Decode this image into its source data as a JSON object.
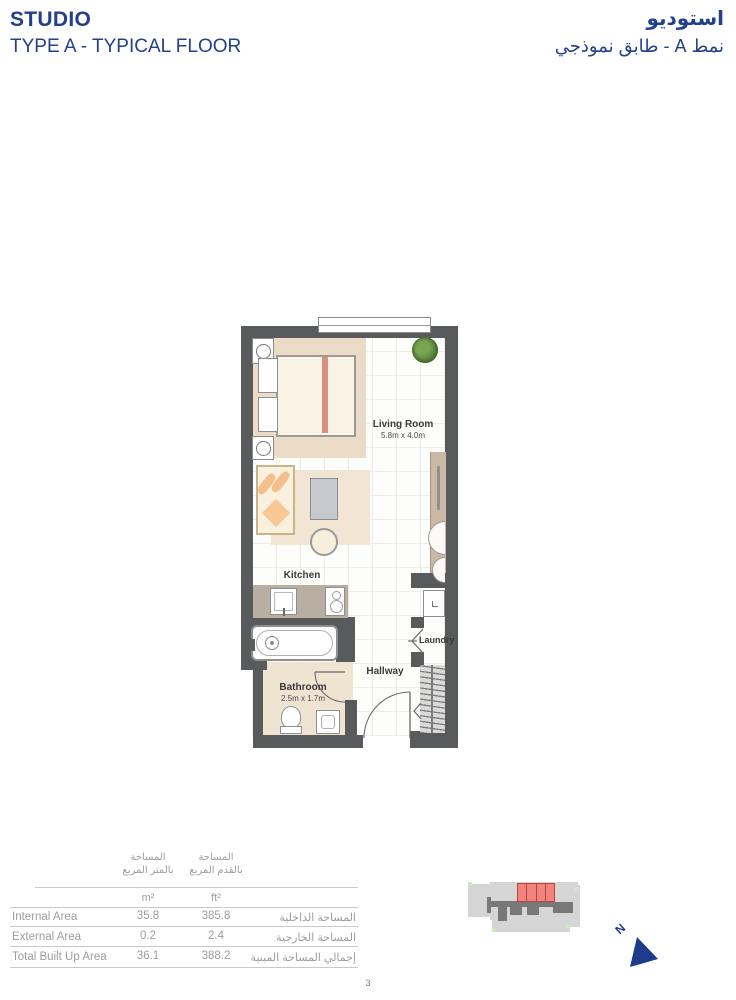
{
  "header": {
    "title_en": "STUDIO",
    "subtitle_en": "TYPE A - TYPICAL FLOOR",
    "title_ar": "استوديو",
    "subtitle_ar": "نمط A - طابق نموذجي",
    "accent_color": "#24408D"
  },
  "floor_plan": {
    "rooms": {
      "living_room": {
        "label": "Living Room",
        "dims": "5.8m x 4.0m"
      },
      "kitchen": {
        "label": "Kitchen"
      },
      "bathroom": {
        "label": "Bathroom",
        "dims": "2.5m x 1.7m"
      },
      "hallway": {
        "label": "Hallway"
      },
      "laundry": {
        "label": "Laundry"
      }
    },
    "colors": {
      "wall": "#595A5C",
      "bedroom_carpet": "#EBDCC8",
      "living_rug": "#F3E5D3",
      "kitchen_counter": "#B9AEA2",
      "wardrobe": "#CBB9A5",
      "bed_runner": "#D98E80"
    }
  },
  "area_table": {
    "col_headers_ar": [
      {
        "line1": "المساحة",
        "line2": "بالمتر المربع"
      },
      {
        "line1": "المساحة",
        "line2": "بالقدم المربع"
      }
    ],
    "unit_headers": [
      "m²",
      "ft²"
    ],
    "rows": [
      {
        "label_en": "Internal Area",
        "m2": "35.8",
        "ft2": "385.8",
        "label_ar": "المساحة الداخلية"
      },
      {
        "label_en": "External Area",
        "m2": "0.2",
        "ft2": "2.4",
        "label_ar": "المساحة الخارجية"
      },
      {
        "label_en": "Total Built Up Area",
        "m2": "36.1",
        "ft2": "388.2",
        "label_ar": "إجمالي المساحة المبنية"
      }
    ]
  },
  "key_plan": {
    "highlight_color": "#F2837D",
    "north_label": "N"
  },
  "page_number": "3"
}
